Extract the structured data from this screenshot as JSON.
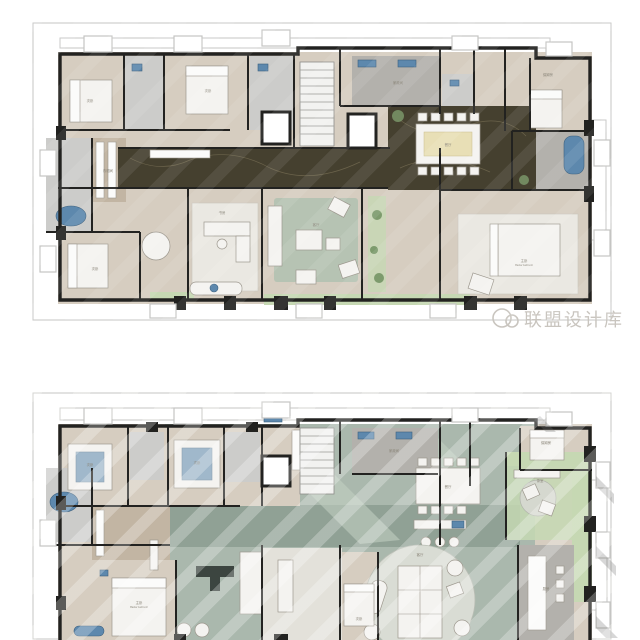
{
  "watermark": {
    "icon": "panda-logo-icon",
    "text": "联盟设计库"
  },
  "colors": {
    "paper": "#ffffff",
    "outline": "#c5c5c3",
    "wall": "#222220",
    "wood": "#d6cdc0",
    "wood2": "#c2b5a3",
    "tile": "#ccccca",
    "tiledark": "#b3b1ac",
    "marble": "#45402f",
    "marblevein": "#8a7f63",
    "teal": "#aab8ad",
    "tealdark": "#90a195",
    "green": "#c6d8b3",
    "plant": "#7d9b6d",
    "blue": "#5d88ad",
    "furn": "#f4f3f0",
    "furnstroke": "#9c978d",
    "rug": "#eae8e2",
    "ruggreen": "#b6c3b3",
    "labelcolor": "#8a8579",
    "wmcolor": "#c9c5bf"
  },
  "plans": [
    {
      "id": "upper-plan",
      "rooms": [
        {
          "label": "次卧",
          "en": "Second bedroom"
        },
        {
          "label": "次卧",
          "en": "Second bedroom"
        },
        {
          "label": "家政间",
          "en": ""
        },
        {
          "label": "保姆房",
          "en": "Maid room"
        },
        {
          "label": "餐厅",
          "en": "Dining room"
        },
        {
          "label": "书房",
          "en": ""
        },
        {
          "label": "客厅",
          "en": "Living room"
        },
        {
          "label": "主卧",
          "en": "Master bedroom"
        },
        {
          "label": "衣帽间",
          "en": ""
        },
        {
          "label": "次卧",
          "en": "Second bedroom"
        }
      ]
    },
    {
      "id": "lower-plan",
      "rooms": [
        {
          "label": "次卧",
          "en": "Second bedroom"
        },
        {
          "label": "次卧",
          "en": "Second bedroom"
        },
        {
          "label": "家政间",
          "en": ""
        },
        {
          "label": "保姆房",
          "en": "Maid room"
        },
        {
          "label": "餐厅",
          "en": "Dining room"
        },
        {
          "label": "客厅",
          "en": "Living room"
        },
        {
          "label": "主卧",
          "en": "Master bedroom"
        },
        {
          "label": "厨房",
          "en": "Kitchen"
        },
        {
          "label": "茶室",
          "en": "Tea room"
        },
        {
          "label": "次卧",
          "en": ""
        }
      ]
    }
  ]
}
